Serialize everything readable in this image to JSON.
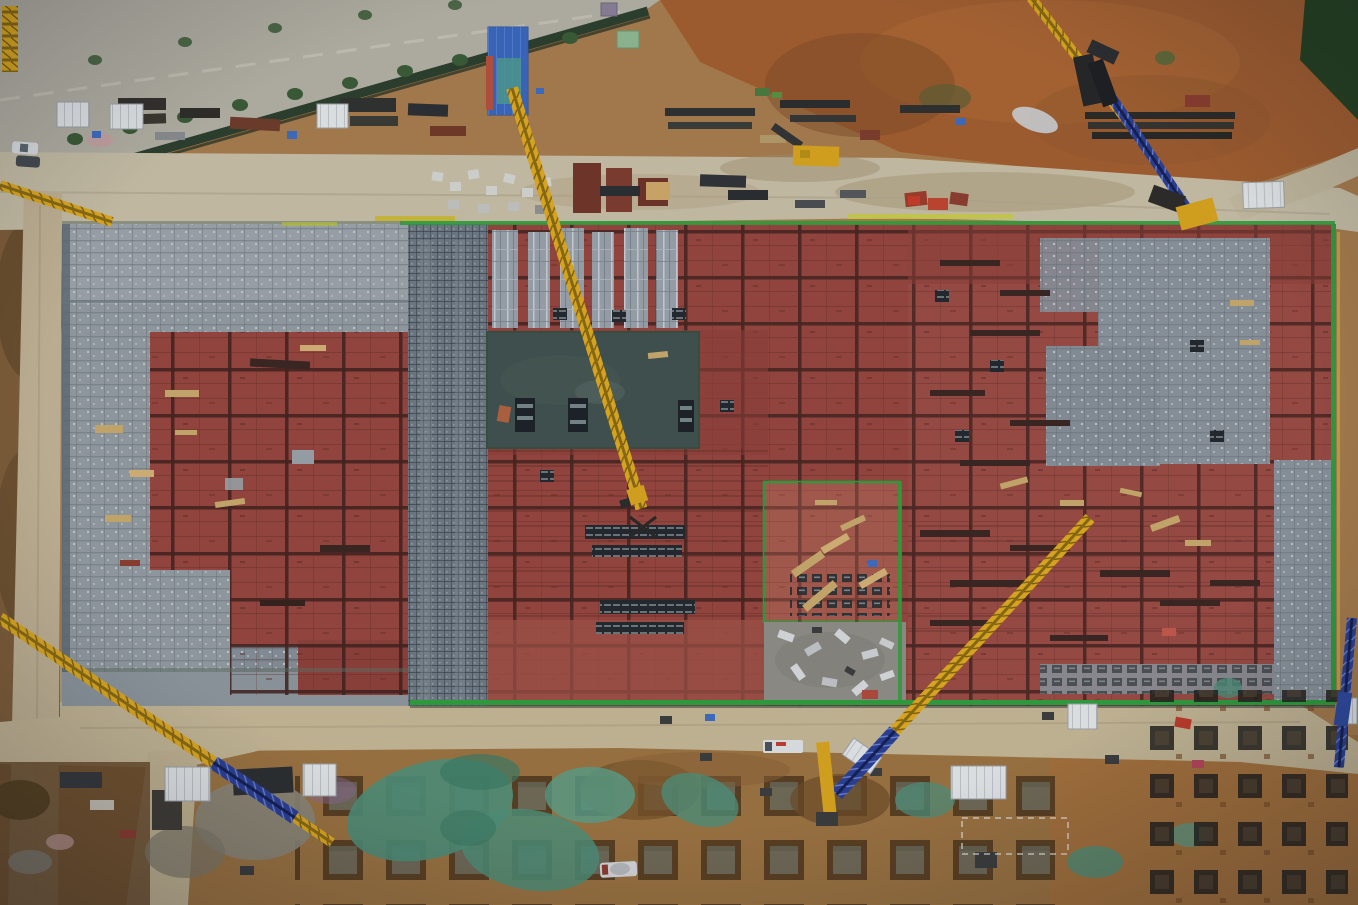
{
  "scene": {
    "setting": "aerial drone photo, top-down view of a large industrial construction site at dusk",
    "subject": "rectangular building slab under construction covered with red steel formwork and gray scaffolding grids, surrounded by haul roads, laydown yards, pile-cap excavations and multiple cranes",
    "regions": [
      "tree-lined-road-top-left",
      "green-perimeter-fence",
      "north-laydown-yard",
      "main-haul-road",
      "building-slab",
      "left-scaffold-block",
      "red-formwork-areas",
      "poured-concrete-slab",
      "aluminum-formwork-strips",
      "green-safety-netting-edges",
      "south-haul-road",
      "pile-pit-field",
      "teal-mesh-ground-covers",
      "rebar-cage-storage",
      "orange-subsoil-northeast",
      "dark-laydown-southwest"
    ],
    "objects": {
      "tower_crane_booms": 4,
      "crawler_crane_booms": 3,
      "mobile_machines": 3,
      "site_sheds": 10,
      "vehicles": 4,
      "pile_pit_rows": 3,
      "material_stacks": "many"
    }
  },
  "palette": {
    "earth": "#a87c4b",
    "earth_orange": "#a35d2e",
    "earth_south": "#9c7240",
    "asphalt": "#b4afa3",
    "road": "#c8bea5",
    "building_gray": "#8e969c",
    "scaffold_dark": "#6e7983",
    "formwork_red": "#96453d",
    "formwork_red_light": "#a85a4c",
    "slab_concrete": "#41514d",
    "concrete_gray": "#8f8d86",
    "net_green": "#2f9e3b",
    "mesh_teal": "#4f8f78",
    "crane_yellow": "#dfa91d",
    "crane_blue": "#2b3f94",
    "shed_white": "#e3e6e8",
    "shed_blue": "#3a66bd",
    "shed_green": "#8fb892",
    "fence_green": "#2c3f2c",
    "tree_green": "#3a5a34",
    "lumber_tan": "#c9a96a",
    "pit_brown": "#4f361b",
    "steel_dark": "#26231f"
  }
}
